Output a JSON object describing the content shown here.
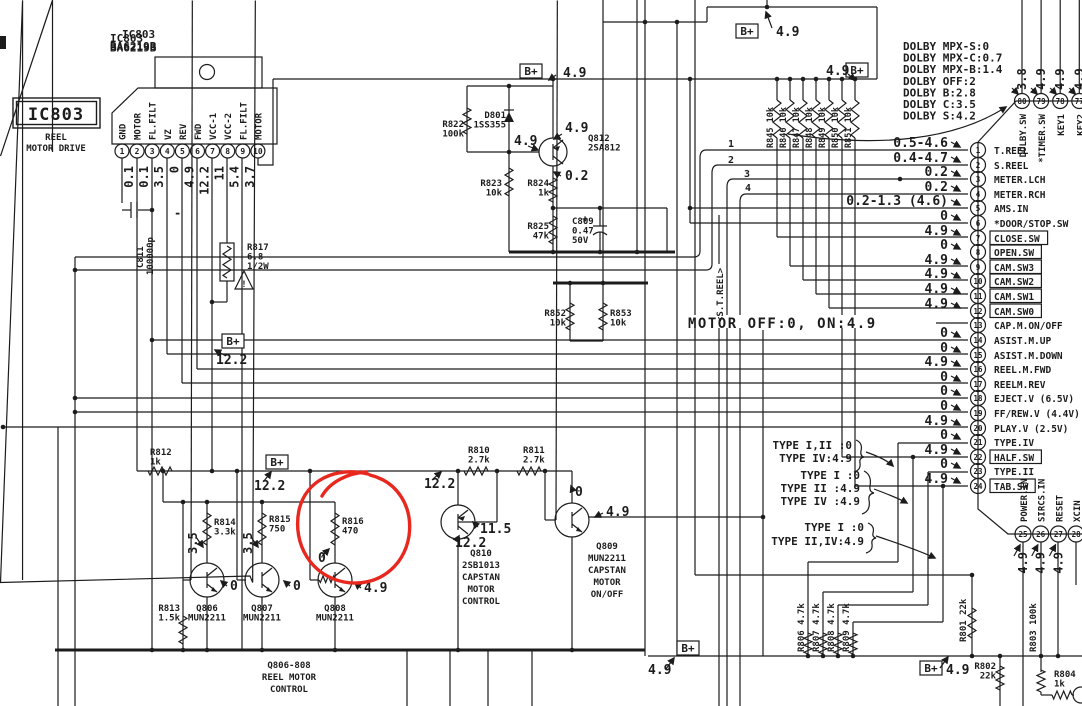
{
  "palette": {
    "ink": "#1c1c1c",
    "bg": "#ffffff",
    "annotation_red": "#e8281e"
  },
  "bplus": "B+",
  "title": {
    "ref": "IC803",
    "part": "BA6219B"
  },
  "label_box": {
    "ref": "IC803",
    "line1": "REEL",
    "line2": "MOTOR DRIVE"
  },
  "ic803": {
    "pins": [
      {
        "n": "1",
        "name": "GND"
      },
      {
        "n": "2",
        "name": "MOTOR"
      },
      {
        "n": "3",
        "name": "FL.FILT"
      },
      {
        "n": "4",
        "name": "VZ"
      },
      {
        "n": "5",
        "name": "REV"
      },
      {
        "n": "6",
        "name": "FWD"
      },
      {
        "n": "7",
        "name": "VCC-1"
      },
      {
        "n": "8",
        "name": "VCC-2"
      },
      {
        "n": "9",
        "name": "FL.FILT"
      },
      {
        "n": "10",
        "name": "MOTOR"
      }
    ],
    "values": [
      "0.1",
      "0.1",
      "3.5",
      "0",
      "4.9",
      "12.2",
      "11",
      "5.4",
      "3.7"
    ]
  },
  "resistor_bank": [
    "R845 10k",
    "R846 10k",
    "R847 10k",
    "R848 10k",
    "R849 10k",
    "R850 10k",
    "R851 10k"
  ],
  "dolby_modes": [
    "DOLBY MPX-S:0",
    "DOLBY MPX-C:0.7",
    "DOLBY MPX-B:1.4",
    "DOLBY OFF:2",
    "DOLBY B:2.8",
    "DOLBY C:3.5",
    "DOLBY S:4.2"
  ],
  "main_ic": {
    "left_pins": [
      {
        "n": "1",
        "v": "0.5-4.6",
        "label": "T.REEL",
        "boxed": false
      },
      {
        "n": "2",
        "v": "0.4-4.7",
        "label": "S.REEL",
        "boxed": false
      },
      {
        "n": "3",
        "v": "0.2",
        "label": "METER.LCH",
        "boxed": false
      },
      {
        "n": "4",
        "v": "0.2",
        "label": "METER.RCH",
        "boxed": false
      },
      {
        "n": "5",
        "v": "0.2-1.3 (4.6)",
        "label": "AMS.IN",
        "boxed": false
      },
      {
        "n": "6",
        "v": "0",
        "label": "*DOOR/STOP.SW",
        "boxed": false
      },
      {
        "n": "7",
        "v": "4.9",
        "label": "CLOSE.SW",
        "boxed": true
      },
      {
        "n": "8",
        "v": "0",
        "label": "OPEN.SW",
        "boxed": true
      },
      {
        "n": "9",
        "v": "4.9",
        "label": "CAM.SW3",
        "boxed": true
      },
      {
        "n": "10",
        "v": "4.9",
        "label": "CAM.SW2",
        "boxed": true
      },
      {
        "n": "11",
        "v": "4.9",
        "label": "CAM.SW1",
        "boxed": true
      },
      {
        "n": "12",
        "v": "4.9",
        "label": "CAM.SW0",
        "boxed": true
      },
      {
        "n": "13",
        "v": "",
        "label": "CAP.M.ON/OFF",
        "boxed": false
      },
      {
        "n": "14",
        "v": "0",
        "label": "ASIST.M.UP",
        "boxed": false
      },
      {
        "n": "15",
        "v": "0",
        "label": "ASIST.M.DOWN",
        "boxed": false
      },
      {
        "n": "16",
        "v": "4.9",
        "label": "REEL.M.FWD",
        "boxed": false
      },
      {
        "n": "17",
        "v": "0",
        "label": "REELM.REV",
        "boxed": false
      },
      {
        "n": "18",
        "v": "0",
        "label": "EJECT.V (6.5V)",
        "boxed": false
      },
      {
        "n": "19",
        "v": "0",
        "label": "FF/REW.V (4.4V)",
        "boxed": false
      },
      {
        "n": "20",
        "v": "4.9",
        "label": "PLAY.V (2.5V)",
        "boxed": false
      },
      {
        "n": "21",
        "v": "0",
        "label": "TYPE.IV",
        "boxed": false
      },
      {
        "n": "22",
        "v": "4.9",
        "label": "HALF.SW",
        "boxed": true
      },
      {
        "n": "23",
        "v": "0",
        "label": "TYPE.II",
        "boxed": false
      },
      {
        "n": "24",
        "v": "4.9",
        "label": "TAB.SW",
        "boxed": true
      }
    ],
    "top_pins": [
      {
        "n": "80",
        "v": "3.8",
        "label": "DOLBY.SW"
      },
      {
        "n": "79",
        "v": "4.9",
        "label": "*TIMER.SW"
      },
      {
        "n": "78",
        "v": "4.9",
        "label": "KEY1"
      },
      {
        "n": "77",
        "v": "4.9",
        "label": "KEY2"
      }
    ],
    "bottom_pins": [
      {
        "n": "25",
        "v": "4.9",
        "label": "POWER.IN"
      },
      {
        "n": "26",
        "v": "4.9",
        "label": "SIRCS.IN"
      },
      {
        "n": "27",
        "v": "4.9",
        "label": "RESET"
      },
      {
        "n": "28",
        "v": "",
        "label": "XCIN"
      },
      {
        "n": "29",
        "v": "",
        "label": "XCOUT"
      }
    ]
  },
  "labels": [
    {
      "lines": [
        "IC803",
        "BA6219B"
      ],
      "x": 110,
      "y": 42,
      "anchor": "start",
      "fs": 11
    },
    {
      "lines": [
        "R822",
        "100k"
      ],
      "x": 464,
      "y": 127,
      "anchor": "end",
      "fs": 9
    },
    {
      "lines": [
        "D801",
        "1SS355"
      ],
      "x": 506,
      "y": 118,
      "anchor": "end",
      "fs": 9
    },
    {
      "lines": [
        "Q812",
        "2SA812"
      ],
      "x": 588,
      "y": 141,
      "anchor": "start",
      "fs": 9
    },
    {
      "lines": [
        "R823",
        "10k"
      ],
      "x": 502,
      "y": 186,
      "anchor": "end",
      "fs": 9
    },
    {
      "lines": [
        "R824",
        "1k"
      ],
      "x": 549,
      "y": 186,
      "anchor": "end",
      "fs": 9
    },
    {
      "lines": [
        "R825",
        "47k"
      ],
      "x": 549,
      "y": 229,
      "anchor": "end",
      "fs": 9
    },
    {
      "lines": [
        "C809",
        "0.47",
        "50V"
      ],
      "x": 572,
      "y": 224,
      "anchor": "start",
      "fs": 9
    },
    {
      "lines": [
        "R852",
        "10k"
      ],
      "x": 566,
      "y": 316,
      "anchor": "end",
      "fs": 9
    },
    {
      "lines": [
        "R853",
        "10k"
      ],
      "x": 610,
      "y": 316,
      "anchor": "start",
      "fs": 9
    },
    {
      "lines": [
        "R812",
        "1k"
      ],
      "x": 150,
      "y": 455,
      "anchor": "start",
      "fs": 9
    },
    {
      "lines": [
        "R813",
        "1.5k"
      ],
      "x": 180,
      "y": 611,
      "anchor": "end",
      "fs": 9
    },
    {
      "lines": [
        "R814",
        "3.3k"
      ],
      "x": 214,
      "y": 525,
      "anchor": "start",
      "fs": 9
    },
    {
      "lines": [
        "R815",
        "750"
      ],
      "x": 269,
      "y": 522,
      "anchor": "start",
      "fs": 9
    },
    {
      "lines": [
        "R816",
        "470"
      ],
      "x": 342,
      "y": 524,
      "anchor": "start",
      "fs": 9
    },
    {
      "lines": [
        "Q806",
        "MUN2211"
      ],
      "x": 207,
      "y": 611,
      "anchor": "middle",
      "fs": 9
    },
    {
      "lines": [
        "Q807",
        "MUN2211"
      ],
      "x": 262,
      "y": 611,
      "anchor": "middle",
      "fs": 9
    },
    {
      "lines": [
        "Q808",
        "MUN2211"
      ],
      "x": 335,
      "y": 611,
      "anchor": "middle",
      "fs": 9
    },
    {
      "lines": [
        "R810",
        "2.7k"
      ],
      "x": 468,
      "y": 453,
      "anchor": "start",
      "fs": 9
    },
    {
      "lines": [
        "R811",
        "2.7k"
      ],
      "x": 523,
      "y": 453,
      "anchor": "start",
      "fs": 9
    },
    {
      "lines": [
        "Q810",
        "2SB1013",
        "CAPSTAN",
        "MOTOR",
        "CONTROL"
      ],
      "x": 481,
      "y": 556,
      "anchor": "middle",
      "fs": 9,
      "lh": 12
    },
    {
      "lines": [
        "Q809",
        "MUN2211",
        "CAPSTAN",
        "MOTOR",
        "ON/OFF"
      ],
      "x": 607,
      "y": 549,
      "anchor": "middle",
      "fs": 9,
      "lh": 12
    },
    {
      "lines": [
        "Q806-808",
        "REEL MOTOR",
        "CONTROL"
      ],
      "x": 289,
      "y": 668,
      "anchor": "middle",
      "fs": 9,
      "lh": 12
    },
    {
      "lines": [
        "R817",
        "6.8",
        "1/2W"
      ],
      "x": 247,
      "y": 250,
      "anchor": "start",
      "fs": 9
    },
    {
      "lines": [
        "R801 22k"
      ],
      "x": 966,
      "y": 642,
      "anchor": "start",
      "fs": 9,
      "rot": -90
    },
    {
      "lines": [
        "R802",
        "22k"
      ],
      "x": 996,
      "y": 669,
      "anchor": "end",
      "fs": 9
    },
    {
      "lines": [
        "R803 100k"
      ],
      "x": 1036,
      "y": 652,
      "anchor": "start",
      "fs": 9,
      "rot": -90
    },
    {
      "lines": [
        "R804",
        "1k"
      ],
      "x": 1054,
      "y": 677,
      "anchor": "start",
      "fs": 9
    },
    {
      "lines": [
        "R806 4.7k"
      ],
      "x": 804,
      "y": 652,
      "anchor": "start",
      "fs": 9,
      "rot": -90
    },
    {
      "lines": [
        "R807 4.7k"
      ],
      "x": 819,
      "y": 652,
      "anchor": "start",
      "fs": 9,
      "rot": -90
    },
    {
      "lines": [
        "R808 4.7k"
      ],
      "x": 834,
      "y": 652,
      "anchor": "start",
      "fs": 9,
      "rot": -90
    },
    {
      "lines": [
        "R809 4.7k"
      ],
      "x": 849,
      "y": 652,
      "anchor": "start",
      "fs": 9,
      "rot": -90
    },
    {
      "lines": [
        "C811"
      ],
      "x": 143,
      "y": 268,
      "anchor": "start",
      "fs": 9,
      "rot": -90
    },
    {
      "lines": [
        "100000p"
      ],
      "x": 153,
      "y": 275,
      "anchor": "start",
      "fs": 9,
      "rot": -90
    },
    {
      "lines": [
        "<S.T.REEL>"
      ],
      "x": 723,
      "y": 322,
      "anchor": "start",
      "fs": 9,
      "rot": -90
    }
  ],
  "floats": [
    {
      "t": "4.9",
      "x": 563,
      "y": 77,
      "fs": 13
    },
    {
      "t": "4.9",
      "x": 776,
      "y": 36,
      "fs": 13
    },
    {
      "t": "4.9",
      "x": 826,
      "y": 75,
      "fs": 13
    },
    {
      "t": "12.2",
      "x": 216,
      "y": 364,
      "fs": 13
    },
    {
      "t": "12.2",
      "x": 254,
      "y": 490,
      "fs": 13
    },
    {
      "t": "12.2",
      "x": 424,
      "y": 488,
      "fs": 13
    },
    {
      "t": "4.9",
      "x": 514,
      "y": 145,
      "fs": 13
    },
    {
      "t": "4.9",
      "x": 565,
      "y": 132,
      "fs": 13
    },
    {
      "t": "0.2",
      "x": 565,
      "y": 180,
      "fs": 13
    },
    {
      "t": "0",
      "x": 575,
      "y": 496,
      "fs": 13
    },
    {
      "t": "4.9",
      "x": 606,
      "y": 516,
      "fs": 13
    },
    {
      "t": "11.5",
      "x": 480,
      "y": 533,
      "fs": 13
    },
    {
      "t": "12.2",
      "x": 455,
      "y": 547,
      "fs": 13
    },
    {
      "t": "3.5",
      "x": 197,
      "y": 554,
      "fs": 12,
      "rot": -90
    },
    {
      "t": "3.5",
      "x": 252,
      "y": 554,
      "fs": 12,
      "rot": -90
    },
    {
      "t": "0",
      "x": 318,
      "y": 562,
      "fs": 13
    },
    {
      "t": "0",
      "x": 230,
      "y": 590,
      "fs": 13
    },
    {
      "t": "0",
      "x": 293,
      "y": 590,
      "fs": 13
    },
    {
      "t": "4.9",
      "x": 364,
      "y": 592,
      "fs": 13
    },
    {
      "t": "MOTOR OFF:0, ON:4.9",
      "x": 688,
      "y": 328,
      "fs": 14
    },
    {
      "t": "4.9",
      "x": 648,
      "y": 674,
      "fs": 13
    },
    {
      "t": "4.9",
      "x": 946,
      "y": 674,
      "fs": 13
    },
    {
      "t": "1",
      "x": 728,
      "y": 147,
      "fs": 10
    },
    {
      "t": "2",
      "x": 728,
      "y": 163,
      "fs": 10
    },
    {
      "t": "3",
      "x": 744,
      "y": 177,
      "fs": 10
    },
    {
      "t": "4",
      "x": 745,
      "y": 191,
      "fs": 10
    },
    {
      "t": "-",
      "x": 174,
      "y": 217,
      "fs": 12
    },
    {
      "t": "TYPE I,II :0",
      "x": 852,
      "y": 449,
      "fs": 11,
      "anchor": "end"
    },
    {
      "t": "TYPE IV:4.9",
      "x": 852,
      "y": 462,
      "fs": 11,
      "anchor": "end"
    },
    {
      "t": "TYPE I :0",
      "x": 860,
      "y": 479,
      "fs": 11,
      "anchor": "end"
    },
    {
      "t": "TYPE II :4.9",
      "x": 860,
      "y": 492,
      "fs": 11,
      "anchor": "end"
    },
    {
      "t": "TYPE IV :4.9",
      "x": 860,
      "y": 505,
      "fs": 11,
      "anchor": "end"
    },
    {
      "t": "TYPE I :0",
      "x": 864,
      "y": 531,
      "fs": 11,
      "anchor": "end"
    },
    {
      "t": "TYPE II,IV:4.9",
      "x": 864,
      "y": 545,
      "fs": 11,
      "anchor": "end"
    }
  ]
}
